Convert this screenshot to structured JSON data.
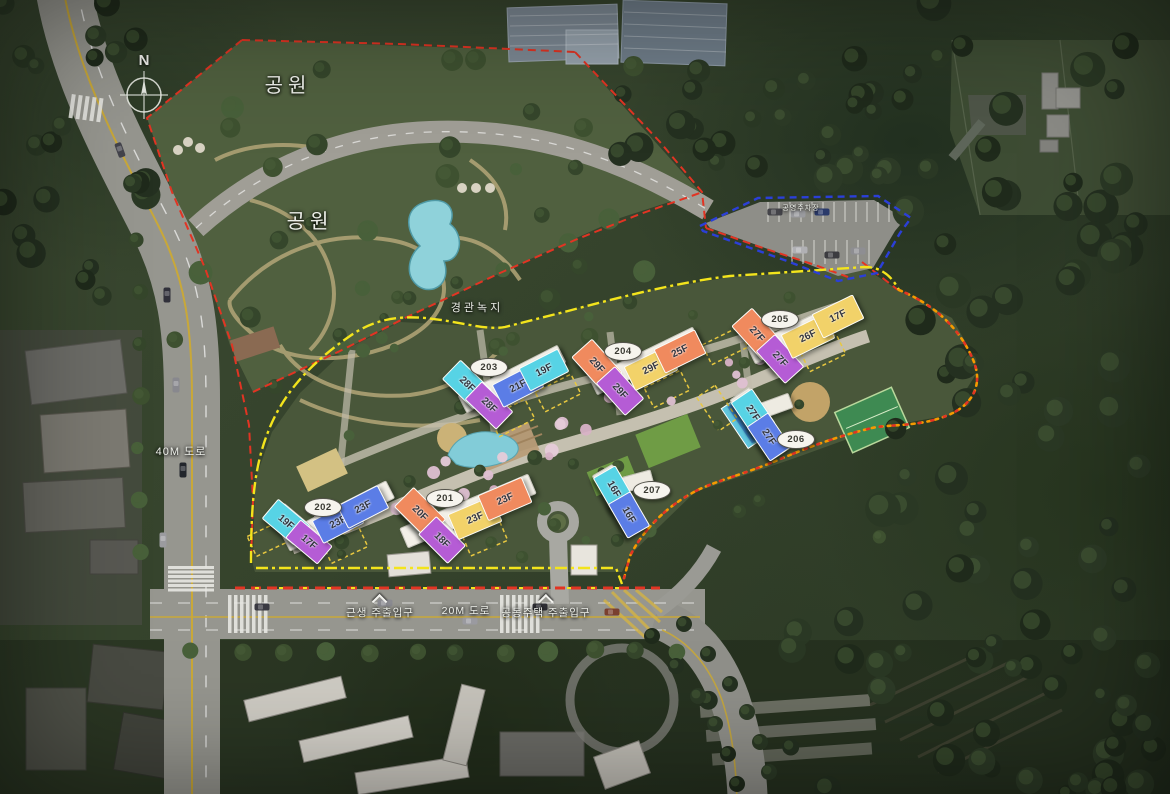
{
  "compass": {
    "label": "N"
  },
  "colors": {
    "cyan": "#57d3e5",
    "blue": "#5b7de6",
    "purple": "#b55cd5",
    "orange": "#f08a5e",
    "yellow": "#f2d269",
    "boundary_red": "#e23423",
    "boundary_yellow": "#f3e41c",
    "boundary_blue": "#2b3fd8",
    "boundary_orange": "#f59a00"
  },
  "area_labels": [
    {
      "id": "park-upper",
      "text": "공원",
      "x": 288,
      "y": 86,
      "size": 20,
      "spacing": 5,
      "marker": false
    },
    {
      "id": "park-lower",
      "text": "공원",
      "x": 310,
      "y": 222,
      "size": 20,
      "spacing": 5,
      "marker": false
    },
    {
      "id": "landscape-green",
      "text": "경관녹지",
      "x": 477,
      "y": 308,
      "size": 11,
      "spacing": 3,
      "marker": false
    },
    {
      "id": "road-40m",
      "text": "40M 도로",
      "x": 181,
      "y": 452,
      "size": 11,
      "spacing": 1,
      "marker": false
    },
    {
      "id": "road-20m",
      "text": "20M 도로",
      "x": 466,
      "y": 612,
      "size": 10.5,
      "spacing": 1,
      "marker": false
    },
    {
      "id": "entrance-retail",
      "text": "근생 주출입구",
      "x": 380,
      "y": 608,
      "size": 10.5,
      "spacing": 1,
      "marker": true
    },
    {
      "id": "entrance-main",
      "text": "공동주택 주출입구",
      "x": 546,
      "y": 608,
      "size": 10.5,
      "spacing": 1,
      "marker": true
    },
    {
      "id": "public-parking",
      "text": "공영주차장",
      "x": 801,
      "y": 209,
      "size": 7,
      "spacing": 1,
      "marker": false
    }
  ],
  "buildings": [
    {
      "id": "201",
      "badge": {
        "label": "201",
        "x": 444,
        "y": 497
      },
      "bases": [
        {
          "x": 468,
          "y": 511,
          "w": 140,
          "h": 22,
          "a": -23
        },
        {
          "x": 429,
          "y": 524,
          "w": 62,
          "h": 26,
          "a": 45
        }
      ],
      "sections": [
        {
          "label": "20F",
          "color": "orange",
          "x": 419,
          "y": 512,
          "w": 44,
          "h": 26,
          "a": 45
        },
        {
          "label": "18F",
          "color": "purple",
          "x": 441,
          "y": 539,
          "w": 40,
          "h": 24,
          "a": 45
        },
        {
          "label": "23F",
          "color": "yellow",
          "x": 474,
          "y": 517,
          "w": 46,
          "h": 26,
          "a": -23
        },
        {
          "label": "23F",
          "color": "orange",
          "x": 504,
          "y": 498,
          "w": 46,
          "h": 26,
          "a": -23
        }
      ]
    },
    {
      "id": "202",
      "badge": {
        "label": "202",
        "x": 322,
        "y": 506
      },
      "bases": [
        {
          "x": 338,
          "y": 516,
          "w": 118,
          "h": 20,
          "a": -27
        },
        {
          "x": 298,
          "y": 530,
          "w": 56,
          "h": 24,
          "a": 40
        }
      ],
      "sections": [
        {
          "label": "19F",
          "color": "cyan",
          "x": 285,
          "y": 521,
          "w": 40,
          "h": 24,
          "a": 40
        },
        {
          "label": "17F",
          "color": "purple",
          "x": 308,
          "y": 541,
          "w": 40,
          "h": 22,
          "a": 40
        },
        {
          "label": "23F",
          "color": "blue",
          "x": 337,
          "y": 521,
          "w": 44,
          "h": 24,
          "a": -27
        },
        {
          "label": "23F",
          "color": "blue",
          "x": 362,
          "y": 506,
          "w": 44,
          "h": 24,
          "a": -27
        }
      ]
    },
    {
      "id": "203",
      "badge": {
        "label": "203",
        "x": 488,
        "y": 366
      },
      "bases": [
        {
          "x": 512,
          "y": 379,
          "w": 112,
          "h": 20,
          "a": -27
        },
        {
          "x": 476,
          "y": 392,
          "w": 56,
          "h": 22,
          "a": 44
        }
      ],
      "sections": [
        {
          "label": "28F",
          "color": "cyan",
          "x": 466,
          "y": 383,
          "w": 42,
          "h": 25,
          "a": 44
        },
        {
          "label": "28F",
          "color": "purple",
          "x": 488,
          "y": 404,
          "w": 42,
          "h": 23,
          "a": 44
        },
        {
          "label": "21F",
          "color": "blue",
          "x": 517,
          "y": 385,
          "w": 44,
          "h": 24,
          "a": -27
        },
        {
          "label": "19F",
          "color": "cyan",
          "x": 543,
          "y": 369,
          "w": 42,
          "h": 24,
          "a": -27
        }
      ]
    },
    {
      "id": "204",
      "badge": {
        "label": "204",
        "x": 622,
        "y": 350
      },
      "bases": [
        {
          "x": 645,
          "y": 361,
          "w": 116,
          "h": 20,
          "a": -26
        },
        {
          "x": 606,
          "y": 376,
          "w": 58,
          "h": 22,
          "a": 48
        }
      ],
      "sections": [
        {
          "label": "29F",
          "color": "orange",
          "x": 596,
          "y": 364,
          "w": 44,
          "h": 26,
          "a": 48
        },
        {
          "label": "29F",
          "color": "purple",
          "x": 619,
          "y": 390,
          "w": 42,
          "h": 24,
          "a": 48
        },
        {
          "label": "29F",
          "color": "yellow",
          "x": 650,
          "y": 367,
          "w": 46,
          "h": 25,
          "a": -26
        },
        {
          "label": "25F",
          "color": "orange",
          "x": 679,
          "y": 350,
          "w": 44,
          "h": 25,
          "a": -26
        }
      ]
    },
    {
      "id": "205",
      "badge": {
        "label": "205",
        "x": 779,
        "y": 318
      },
      "bases": [
        {
          "x": 803,
          "y": 330,
          "w": 116,
          "h": 20,
          "a": -26
        },
        {
          "x": 765,
          "y": 344,
          "w": 58,
          "h": 22,
          "a": 48
        }
      ],
      "sections": [
        {
          "label": "27F",
          "color": "orange",
          "x": 756,
          "y": 333,
          "w": 44,
          "h": 26,
          "a": 48
        },
        {
          "label": "27F",
          "color": "purple",
          "x": 779,
          "y": 358,
          "w": 42,
          "h": 24,
          "a": 48
        },
        {
          "label": "26F",
          "color": "yellow",
          "x": 807,
          "y": 335,
          "w": 46,
          "h": 25,
          "a": -26
        },
        {
          "label": "17F",
          "color": "yellow",
          "x": 837,
          "y": 315,
          "w": 44,
          "h": 25,
          "a": -26
        }
      ]
    },
    {
      "id": "206",
      "badge": {
        "label": "206",
        "x": 795,
        "y": 438
      },
      "bases": [
        {
          "x": 760,
          "y": 424,
          "w": 74,
          "h": 24,
          "a": 56
        },
        {
          "x": 775,
          "y": 406,
          "w": 34,
          "h": 16,
          "a": -20
        }
      ],
      "sections": [
        {
          "label": "27F",
          "color": "cyan",
          "x": 752,
          "y": 412,
          "w": 40,
          "h": 24,
          "a": 56
        },
        {
          "label": "27F",
          "color": "blue",
          "x": 768,
          "y": 436,
          "w": 40,
          "h": 24,
          "a": 56
        }
      ]
    },
    {
      "id": "207",
      "badge": {
        "label": "207",
        "x": 651,
        "y": 489
      },
      "bases": [
        {
          "x": 620,
          "y": 501,
          "w": 72,
          "h": 24,
          "a": 60
        },
        {
          "x": 638,
          "y": 481,
          "w": 30,
          "h": 16,
          "a": -15
        }
      ],
      "sections": [
        {
          "label": "16F",
          "color": "cyan",
          "x": 613,
          "y": 488,
          "w": 38,
          "h": 24,
          "a": 60
        },
        {
          "label": "16F",
          "color": "blue",
          "x": 628,
          "y": 514,
          "w": 38,
          "h": 24,
          "a": 60
        }
      ]
    }
  ]
}
